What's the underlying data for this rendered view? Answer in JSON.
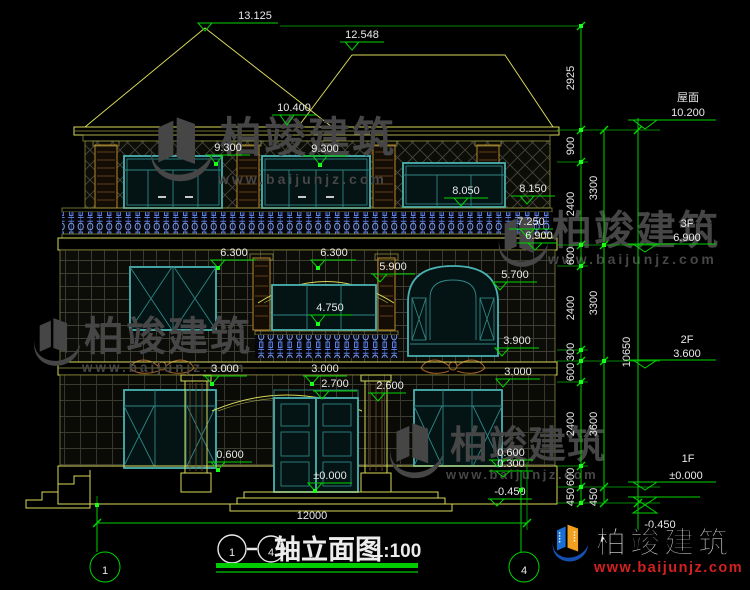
{
  "marks": [
    "13.125",
    "12.548",
    "10.400",
    "9.300",
    "9.300",
    "8.050",
    "8.150",
    "7.250",
    "6.900",
    "6.300",
    "6.300",
    "5.900",
    "5.700",
    "4.750",
    "3.900",
    "3.000",
    "3.000",
    "2.700",
    "2.600",
    "3.000",
    "0.600",
    "0.600",
    "0.300",
    "±0.000",
    "-0.450"
  ],
  "chain1": [
    "2925",
    "900",
    "2400",
    "600",
    "2400",
    "300",
    "600",
    "2400",
    "600",
    "450"
  ],
  "chain2": [
    "3300",
    "3300",
    "3600",
    "450"
  ],
  "total_height_dim": "10650",
  "width_dim": "12000",
  "floors": [
    {
      "label": "屋面",
      "value": "10.200"
    },
    {
      "label": "3F",
      "value": "6.900"
    },
    {
      "label": "2F",
      "value": "3.600"
    },
    {
      "label": "1F",
      "value": "±0.000"
    },
    {
      "label": "",
      "value": "-0.450"
    }
  ],
  "axes": {
    "left": "1",
    "right": "4"
  },
  "title": {
    "from": "1",
    "dash": "-",
    "to": "4",
    "name": "轴立面图",
    "scale": "1:100"
  },
  "watermark": {
    "brand": "柏竣建筑",
    "url": "www.baijunjz.com"
  },
  "logo": {
    "brand": "柏竣建筑",
    "url": "www.baijunjz.com"
  },
  "colors": {
    "dim_green": "#00d400",
    "cad_yellow": "#d8d85a",
    "frame_teal": "#4ab2b2",
    "baluster_blue": "#5b7fe0",
    "watermark_gray": "#464646",
    "logo_blue": "#1a6fd4",
    "logo_orange": "#f0a01e",
    "logo_red": "#d42020"
  }
}
